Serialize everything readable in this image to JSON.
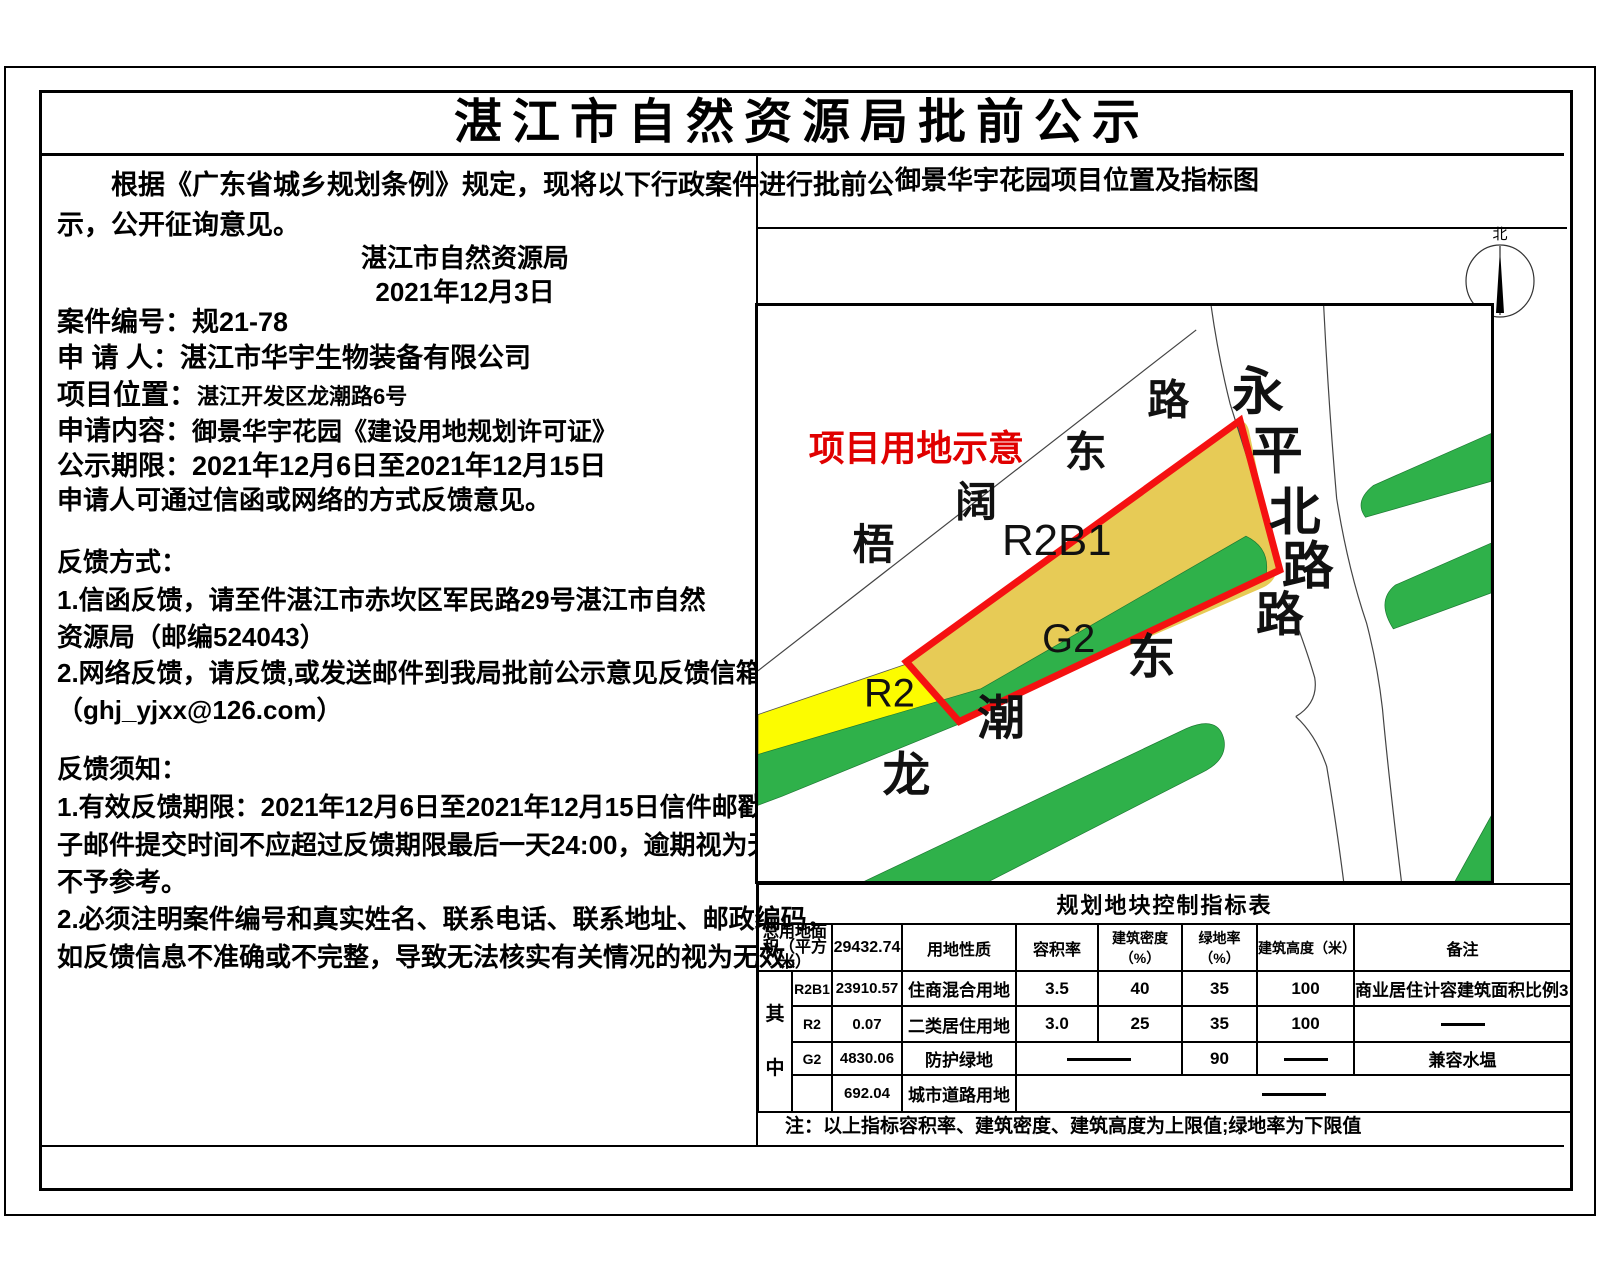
{
  "doc": {
    "title": "湛江市自然资源局批前公示"
  },
  "left": {
    "intro_line1": "根据《广东省城乡规划条例》规定，现将以下行政案件进行批前公",
    "intro_line2": "示，公开征询意见。",
    "org": "湛江市自然资源局",
    "date": "2021年12月3日",
    "fields": [
      {
        "label": "案件编号：",
        "value": "规21-78"
      },
      {
        "label": "申 请 人：",
        "value": "湛江市华宇生物装备有限公司"
      },
      {
        "label": "项目位置：",
        "value": "湛江开发区龙潮路6号"
      },
      {
        "label": "申请内容：",
        "value": "御景华宇花园《建设用地规划许可证》"
      },
      {
        "label": "公示期限：",
        "value": "2021年12月6日至2021年12月15日"
      }
    ],
    "feedback_hint": "申请人可通过信函或网络的方式反馈意见。",
    "ways_title": "反馈方式：",
    "way1a": "1.信函反馈，请至件湛江市赤坎区军民路29号湛江市自然",
    "way1b": "资源局（邮编524043）",
    "way2a": "2.网络反馈，请反馈,或发送邮件到我局批前公示意见反馈信箱",
    "way2b": "（ghj_yjxx@126.com）",
    "notes_title": "反馈须知：",
    "note1a": "1.有效反馈期限：2021年12月6日至2021年12月15日信件邮戳日或电",
    "note1b": "子邮件提交时间不应超过反馈期限最后一天24:00，逾期视为无效，",
    "note1c": "不予参考。",
    "note2a": "2.必须注明案件编号和真实姓名、联系电话、联系地址、邮政编码，",
    "note2b": "如反馈信息不准确或不完整，导致无法核实有关情况的视为无效。"
  },
  "map": {
    "title": "御景华宇花园项目位置及指标图",
    "compass_label": "北",
    "annotation": "项目用地示意",
    "parcels": {
      "r2b1": "R2B1",
      "r2": "R2",
      "g2": "G2"
    },
    "roads": {
      "wukuo": [
        "梧",
        "阔",
        "东",
        "路"
      ],
      "yongping": [
        "永",
        "平",
        "北",
        "路"
      ],
      "longchao": [
        "龙",
        "潮",
        "东",
        "路"
      ]
    },
    "colors": {
      "boundary_red": "#f51111",
      "r2b1_fill": "#e7cb56",
      "r2_fill": "#fcfc00",
      "green_fill": "#2fb14a",
      "annotation_red": "#e00000"
    }
  },
  "table": {
    "title": "规划地块控制指标表",
    "total_label": "总用地面积（平方米）",
    "total_value": "29432.74",
    "col_nature": "用地性质",
    "col_far": "容积率",
    "col_density": "建筑密度（%）",
    "col_green": "绿地率（%）",
    "col_height": "建筑高度（米）",
    "col_remark": "备注",
    "among": "其中",
    "r1": {
      "code": "R2B1",
      "area": "23910.57",
      "nature": "住商混合用地",
      "far": "3.5",
      "density": "40",
      "green": "35",
      "height": "100",
      "remark": "商业居住计容建筑面积比例3：7"
    },
    "r2": {
      "code": "R2",
      "area": "0.07",
      "nature": "二类居住用地",
      "far": "3.0",
      "density": "25",
      "green": "35",
      "height": "100",
      "remark": "——"
    },
    "r3": {
      "code": "G2",
      "area": "4830.06",
      "nature": "防护绿地",
      "far_density": "——",
      "green": "90",
      "height": "——",
      "remark": "兼容水塭"
    },
    "r4": {
      "code": "",
      "area": "692.04",
      "nature": "城市道路用地",
      "rest": "——"
    },
    "note": "注：以上指标容积率、建筑密度、建筑高度为上限值;绿地率为下限值"
  }
}
